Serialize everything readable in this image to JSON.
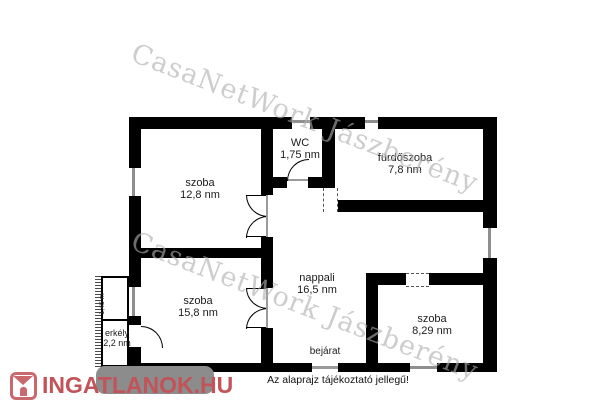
{
  "watermark": {
    "text": "CasaNetWork Jászberény",
    "color": "#c8c8c8"
  },
  "rooms": [
    {
      "name": "szoba",
      "area": "12,8 nm"
    },
    {
      "name": "WC",
      "area": "1,75 nm"
    },
    {
      "name": "fürdőszoba",
      "area": "7,8 nm"
    },
    {
      "name": "szoba",
      "area": "15,8 nm"
    },
    {
      "name": "nappali",
      "area": "16,5 nm"
    },
    {
      "name": "szoba",
      "area": "8,29 nm"
    },
    {
      "name": "erkély",
      "area": "2,2 nm"
    }
  ],
  "labels": {
    "entrance": "bejárat",
    "balcony_dim": "1,45 m"
  },
  "footer": {
    "logo_text": "INGATLANOK.HU",
    "logo_color": "#c25459",
    "disclaimer": "Az alaprajz tájékoztató jellegű!"
  },
  "colors": {
    "wall": "#000000",
    "window": "#8f8f8f",
    "watermark_gray": "#c8c8c8",
    "logo_red": "#c25459",
    "plate_gray": "#8c8c8c"
  }
}
